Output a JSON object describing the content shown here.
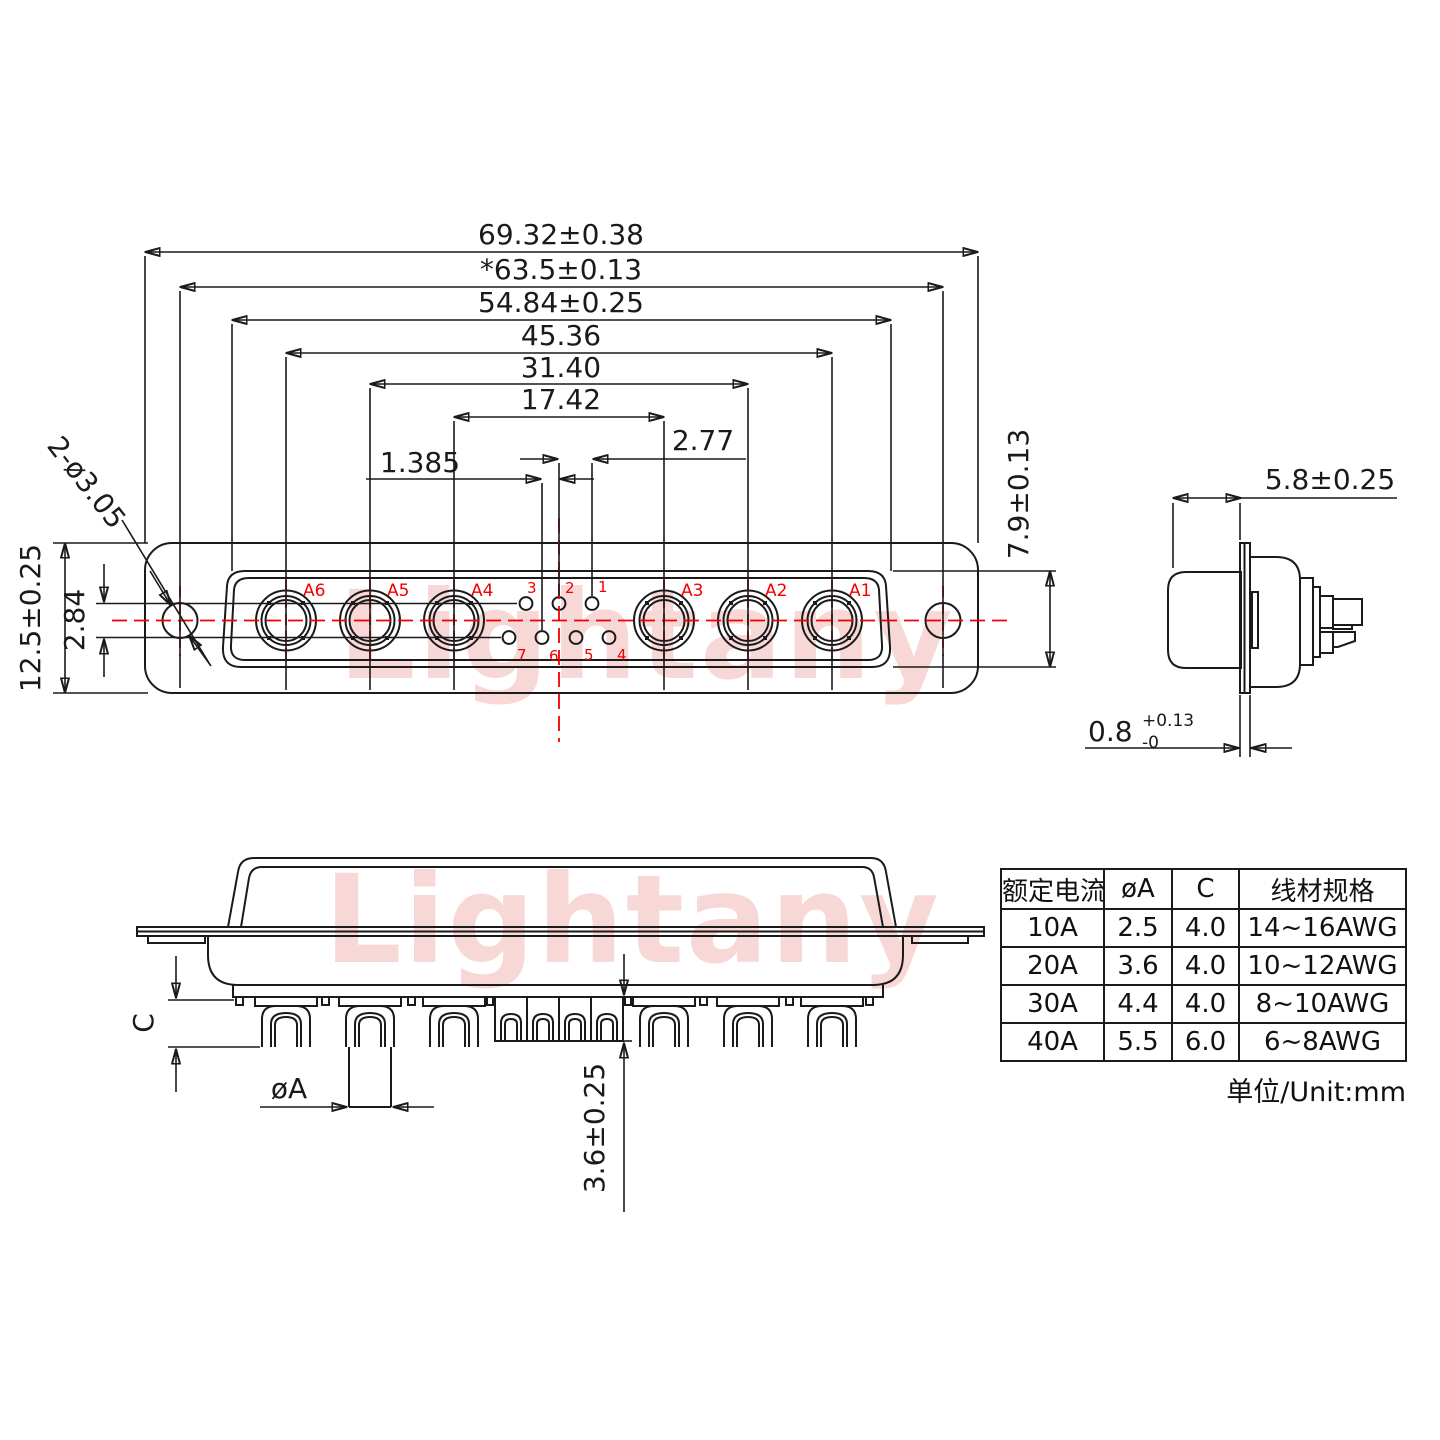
{
  "watermark": {
    "text": "Lightany"
  },
  "face_view": {
    "contacts": [
      "A6",
      "A5",
      "A4",
      "A3",
      "A2",
      "A1"
    ],
    "pins_top": [
      "3",
      "2",
      "1"
    ],
    "pins_bottom": [
      "7",
      "6",
      "5",
      "4"
    ]
  },
  "dims": {
    "overall_width": "69.32±0.38",
    "mounting_span": "*63.5±0.13",
    "insert_width": "54.84±0.25",
    "span_a": "45.36",
    "span_b": "31.40",
    "span_c": "17.42",
    "pin_pitch": "2.77",
    "pin_half_pitch": "1.385",
    "flange_height": "12.5±0.25",
    "row_spacing": "2.84",
    "mounting_holes": "2-ø3.05",
    "mating_depth": "5.8±0.25",
    "insert_height": "7.9±0.13",
    "flange_thk": "0.8",
    "flange_thk_up": "+0.13",
    "flange_thk_dn": "-0",
    "crimp_depth": "C",
    "barrel_dia": "øA",
    "tail_length": "3.6±0.25"
  },
  "table": {
    "headers": [
      "额定电流",
      "øA",
      "C",
      "线材规格"
    ],
    "rows": [
      [
        "10A",
        "2.5",
        "4.0",
        "14~16AWG"
      ],
      [
        "20A",
        "3.6",
        "4.0",
        "10~12AWG"
      ],
      [
        "30A",
        "4.4",
        "4.0",
        "8~10AWG"
      ],
      [
        "40A",
        "5.5",
        "6.0",
        "6~8AWG"
      ]
    ],
    "unit": "单位/Unit:mm"
  }
}
